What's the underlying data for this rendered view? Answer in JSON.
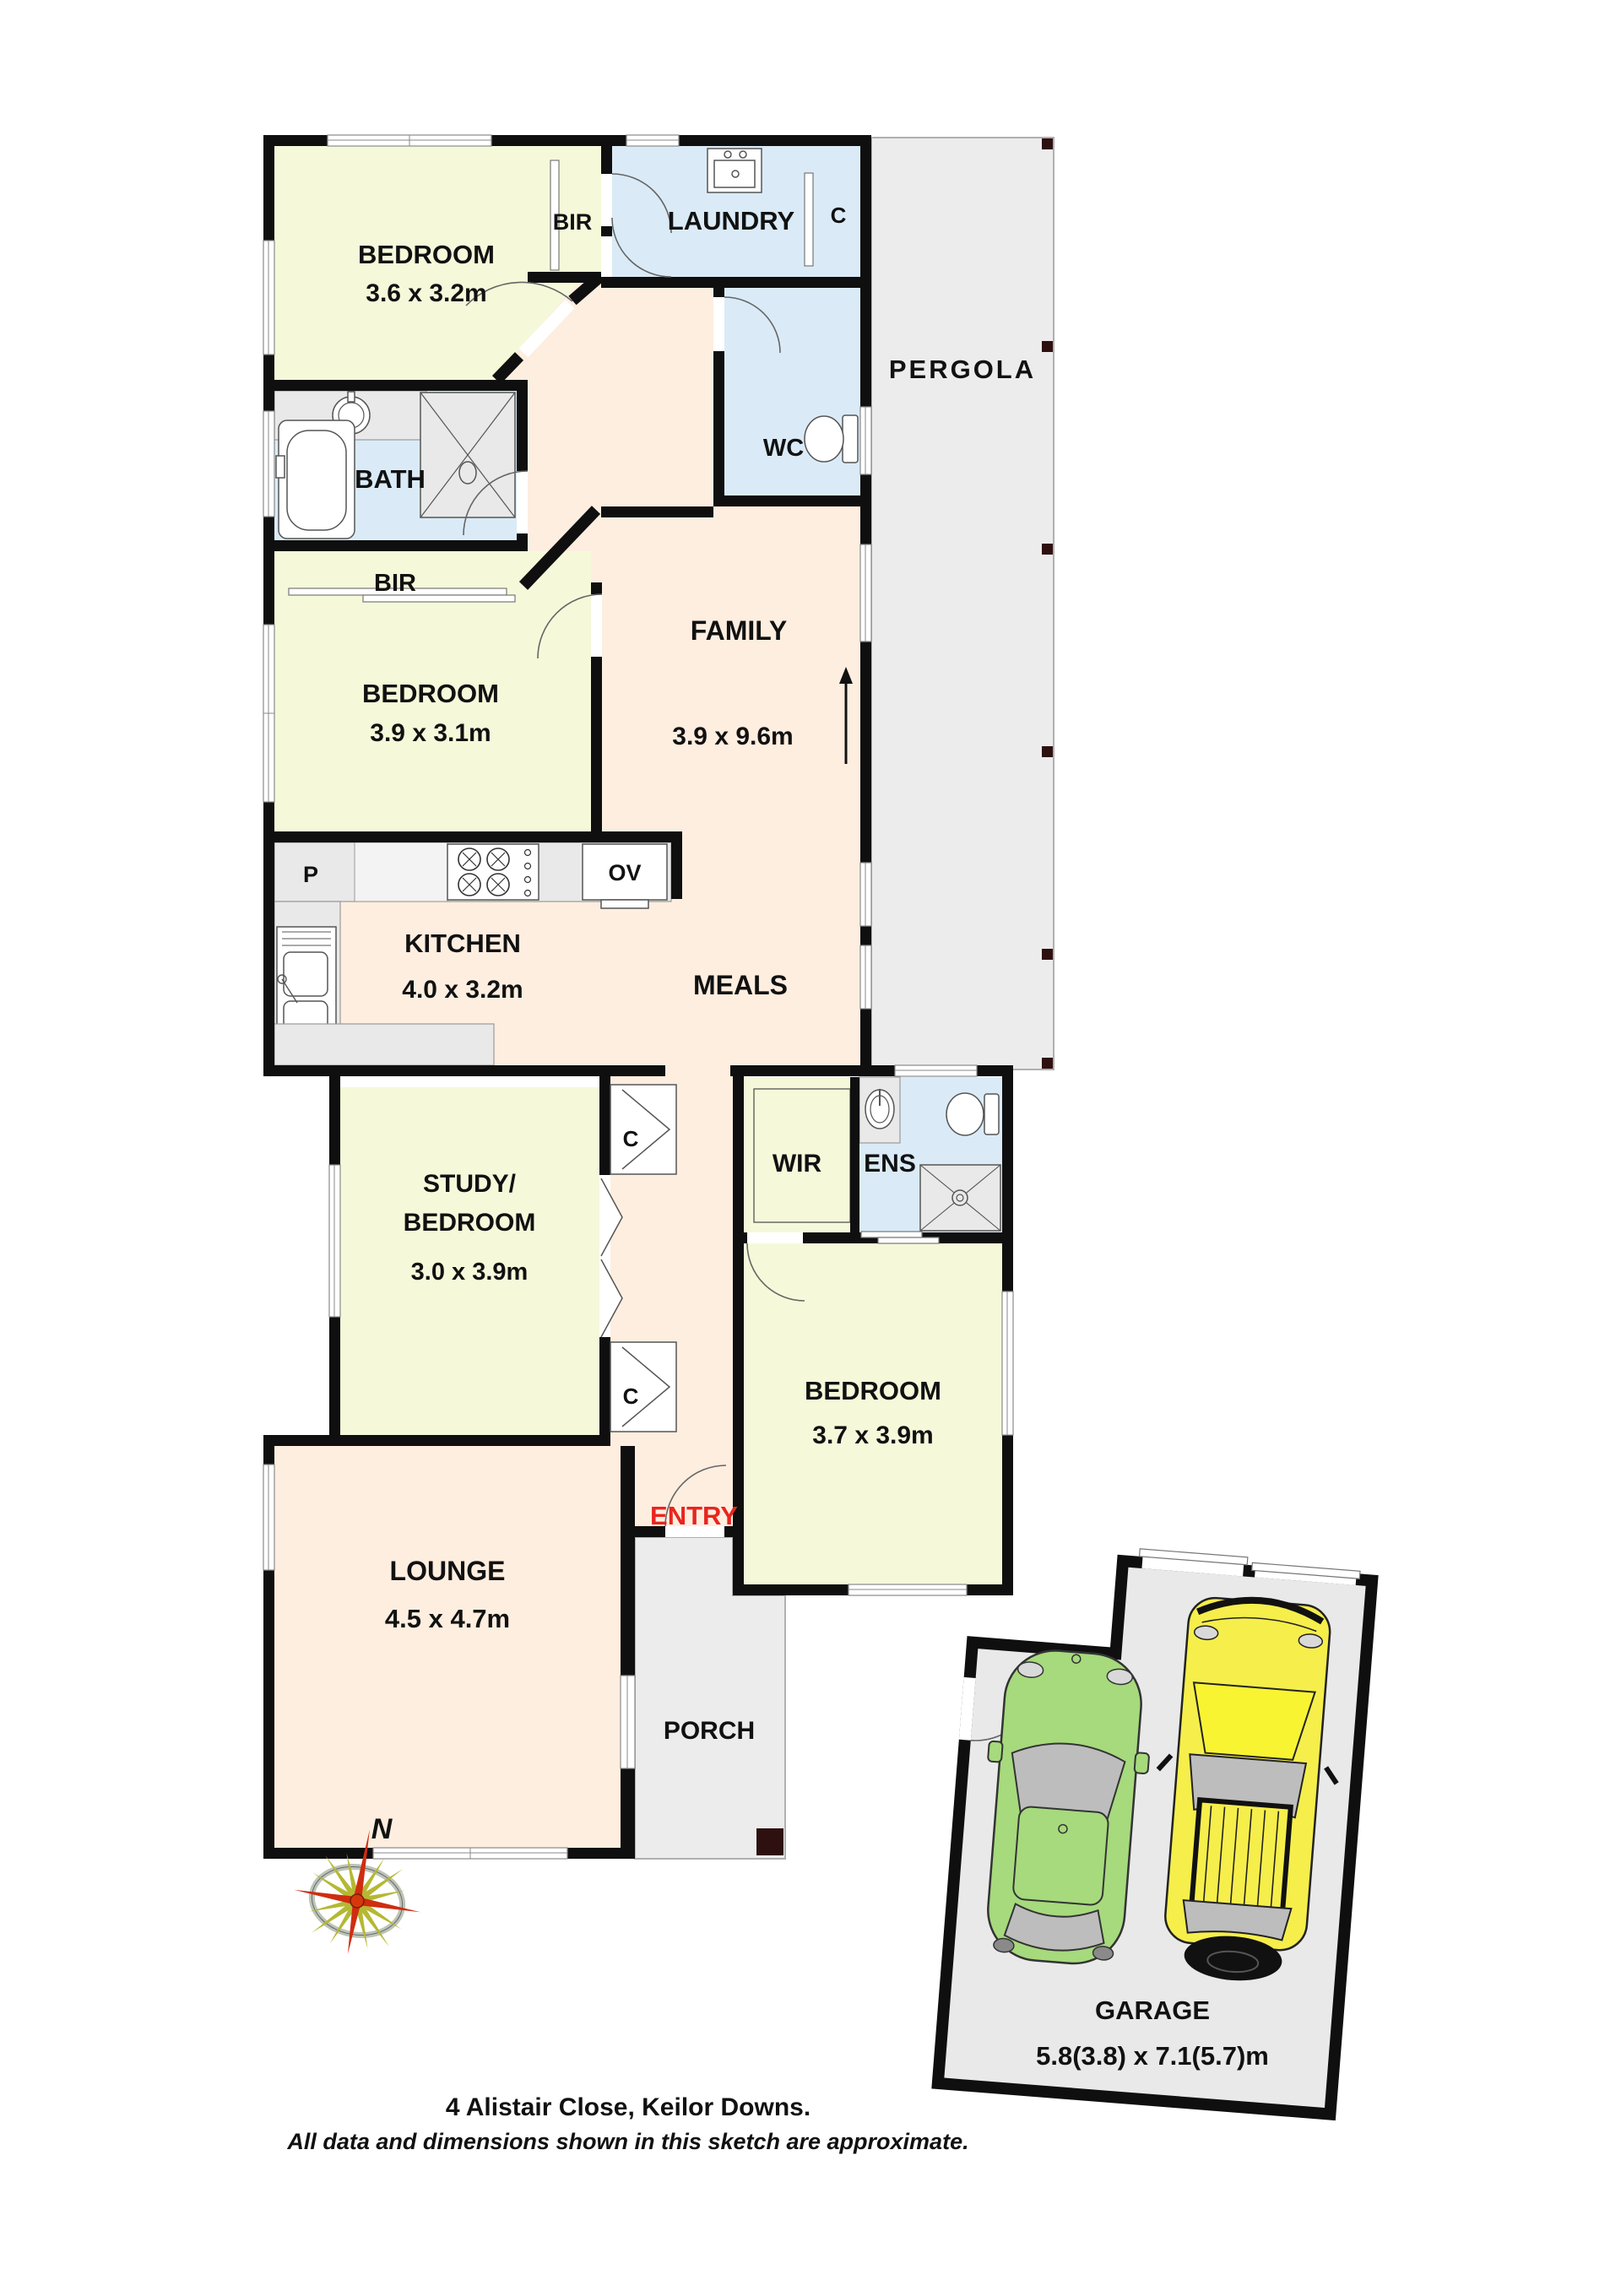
{
  "rooms": {
    "bedroom1": {
      "name": "BEDROOM",
      "dims": "3.6 x 3.2m"
    },
    "bir1": {
      "name": "BIR"
    },
    "laundry": {
      "name": "LAUNDRY"
    },
    "c1": {
      "name": "C"
    },
    "wc": {
      "name": "WC"
    },
    "bath": {
      "name": "BATH"
    },
    "bir2": {
      "name": "BIR"
    },
    "bedroom2": {
      "name": "BEDROOM",
      "dims": "3.9 x 3.1m"
    },
    "family": {
      "name": "FAMILY",
      "dims": "3.9 x 9.6m"
    },
    "meals": {
      "name": "MEALS"
    },
    "kitchen": {
      "name": "KITCHEN",
      "dims": "4.0 x 3.2m"
    },
    "pantry": {
      "name": "P"
    },
    "oven": {
      "name": "OV"
    },
    "pergola": {
      "name": "PERGOLA"
    },
    "study": {
      "name_line1": "STUDY/",
      "name_line2": "BEDROOM",
      "dims": "3.0 x 3.9m"
    },
    "c2": {
      "name": "C"
    },
    "c3": {
      "name": "C"
    },
    "wir": {
      "name": "WIR"
    },
    "ens": {
      "name": "ENS"
    },
    "bedroom3": {
      "name": "BEDROOM",
      "dims": "3.7 x 3.9m"
    },
    "entry": {
      "name": "ENTRY"
    },
    "lounge": {
      "name": "LOUNGE",
      "dims": "4.5 x 4.7m"
    },
    "porch": {
      "name": "PORCH"
    },
    "garage": {
      "name": "GARAGE",
      "dims": "5.8(3.8) x 7.1(5.7)m"
    }
  },
  "compass": {
    "north_label": "N"
  },
  "footer": {
    "address": "4 Alistair Close, Keilor Downs.",
    "disclaimer": "All data and dimensions shown in this sketch are approximate."
  },
  "colors": {
    "wall": "#0f0f0f",
    "living_peach": "#fdeee0",
    "bedroom_green": "#f5f9da",
    "wet_blue": "#daebf7",
    "outdoor_gray": "#ececec",
    "counter_gray": "#e9e9e9",
    "entry_red": "#e8251f",
    "car_green": "#a6da7d",
    "car_yellow": "#f6ee4b",
    "post_brown": "#2f1010"
  }
}
